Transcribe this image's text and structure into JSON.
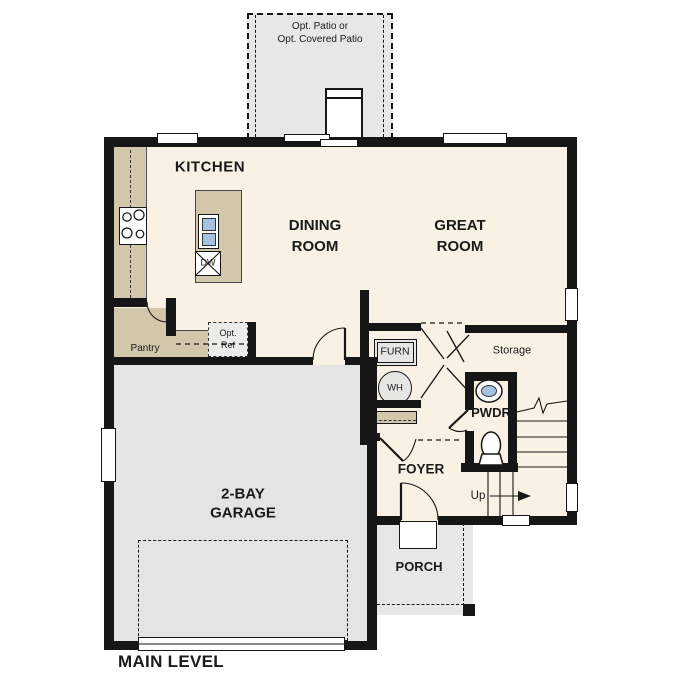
{
  "plan": {
    "level": "MAIN LEVEL"
  },
  "rooms": {
    "kitchen": "KITCHEN",
    "dining": "DINING\nROOM",
    "great": "GREAT\nROOM",
    "garage": "2-BAY\nGARAGE",
    "foyer": "FOYER",
    "porch": "PORCH",
    "powder": "PWDR",
    "storage": "Storage",
    "pantry": "Pantry"
  },
  "fixtures": {
    "furnace": "FURN",
    "water_heater": "WH",
    "dishwasher": "DW",
    "refrigerator": "Opt.\nRef"
  },
  "outdoor": {
    "patio": "Opt. Patio or\nOpt. Covered Patio"
  },
  "stairs": {
    "up": "Up"
  },
  "colors": {
    "wall": "#161616",
    "floor": "#f8f1e4",
    "counter": "#d3c7ab",
    "garage": "#e4e4e2",
    "outdoor": "#e7e7e5",
    "optional": "#ebebe9",
    "fixture": "#e6e6e4",
    "sink": "#a5c2e0",
    "text": "#1a1a1a"
  }
}
